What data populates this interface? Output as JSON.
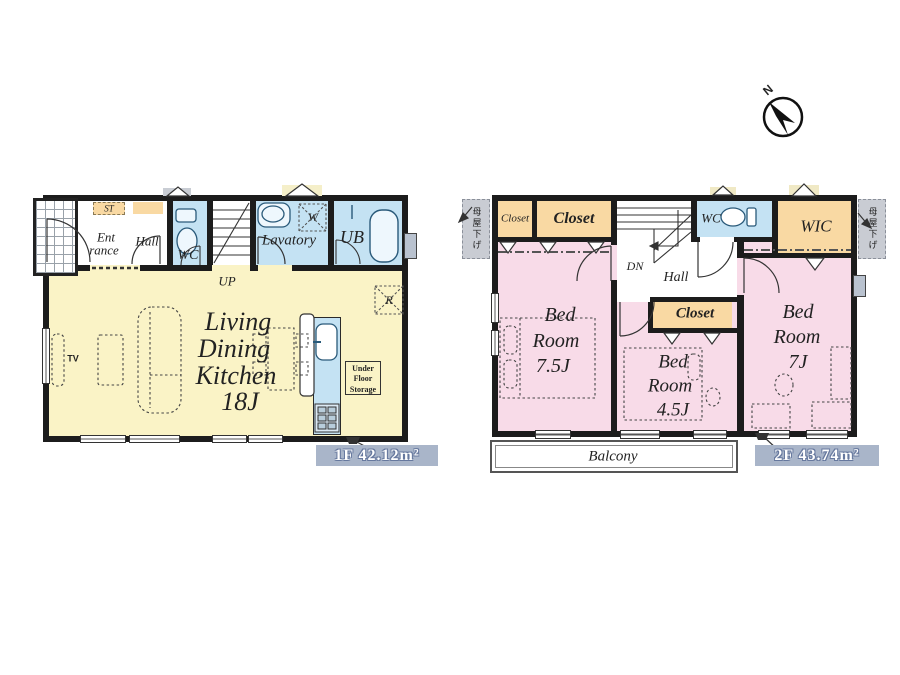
{
  "compass": {
    "north": "N"
  },
  "colors": {
    "ldk_yellow": "#FAF3C6",
    "wet_blue": "#C4E2F3",
    "closet_orange": "#F9D9A3",
    "bedroom_pink": "#F8DBE8",
    "wall": "#1C1C1C",
    "area_badge_bg": "#A9B5C9",
    "area_badge_text": "#FFFFFF"
  },
  "floor1": {
    "area_label": "1F 42.12m²",
    "storage": "ST",
    "entrance_line1": "Ent",
    "entrance_line2": "rance",
    "hall": "Hall",
    "wc": "WC",
    "stairs": "UP",
    "lavatory": "Lavatory",
    "washer": "W",
    "bath": "UB",
    "ldk_line1": "Living",
    "ldk_line2": "Dining",
    "ldk_line3": "Kitchen",
    "ldk_line4": "18J",
    "fridge": "R",
    "under_floor_line1": "Under",
    "under_floor_line2": "Floor",
    "under_floor_line3": "Storage",
    "tv": "TV"
  },
  "floor2": {
    "area_label": "2F 43.74m²",
    "closet_a": "Closet",
    "closet_b": "Closet",
    "closet_c": "Closet",
    "stairs": "DN",
    "hall": "Hall",
    "wc": "WC",
    "wic": "WIC",
    "bedroom1_line1": "Bed",
    "bedroom1_line2": "Room",
    "bedroom1_line3": "7.5J",
    "bedroom2_line1": "Bed",
    "bedroom2_line2": "Room",
    "bedroom2_line3": "4.5J",
    "bedroom3_line1": "Bed",
    "bedroom3_line2": "Room",
    "bedroom3_line3": "7J",
    "balcony": "Balcony",
    "eaves_left": "母屋下げ",
    "eaves_right": "母屋下げ"
  }
}
